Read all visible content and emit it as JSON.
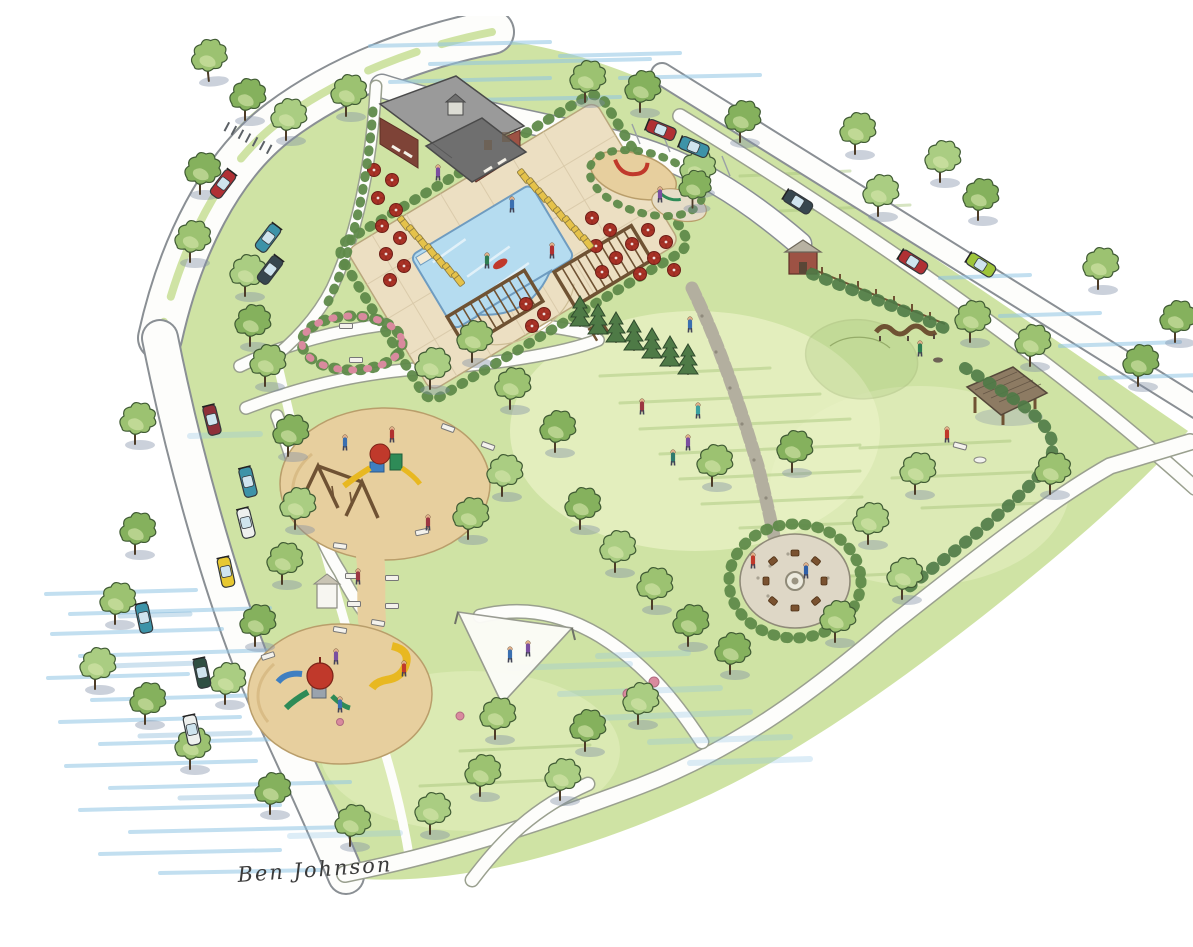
{
  "signature": {
    "text": "Ben Johnson"
  },
  "colors": {
    "page": "#ffffff",
    "grass": "#cfe3a4",
    "grassDark": "#a4c477",
    "lawnLight": "#e9f2c6",
    "water": "#8fc4e4",
    "waterDark": "#5e9ec9",
    "road": "#fdfdfb",
    "roadEdge": "#8a8f94",
    "stone": "#b3af9f",
    "stonePatio": "#ded7c6",
    "sand": "#e7cf9e",
    "sandEdge": "#b99e6b",
    "pool": "#b5dcf0",
    "poolEdge": "#6f9cc0",
    "poolDeck": "#ecdfc2",
    "brick": "#9d5244",
    "brickDark": "#7e4337",
    "roof": "#9a9a9a",
    "roofDark": "#6f6f6f",
    "roofBrown": "#8d7b63",
    "umbrella": "#a93226",
    "lounger": "#e5c24a",
    "pergola": "#6f5233",
    "hedge": "#5f8a4a",
    "evergreen": "#4e7a46",
    "treeA": "#9cc271",
    "treeB": "#85b15d",
    "treeC": "#aacd82",
    "treeHi": "#d8e8ad",
    "treeShadow": "#7e8ba5",
    "trunk": "#4d3c28",
    "flower": "#d98a9e",
    "chair": "#7a5230",
    "equipRed": "#c0392b",
    "slideYellow": "#e8b821",
    "slideGreen": "#2e8b57",
    "slideBlue": "#3f7fc1",
    "carRed": "#b03034",
    "carMaroon": "#8e3039",
    "carTeal": "#3d93a8",
    "carWhite": "#eef0ee",
    "carYellow": "#e7c832",
    "carGreen": "#2f4f42",
    "carDark": "#37474f",
    "carLime": "#9ec43a",
    "ink": "#3a3a3a"
  },
  "features": [
    {
      "id": "clubhouse",
      "label": "Clubhouse"
    },
    {
      "id": "swimming-pool",
      "label": "Swimming pool"
    },
    {
      "id": "pool-terrace",
      "label": "Pool terrace with umbrellas and loungers"
    },
    {
      "id": "pergolas",
      "label": "Pergolas"
    },
    {
      "id": "tot-lot",
      "label": "Tot lot playground"
    },
    {
      "id": "playground-north",
      "label": "North sand playground with swing set"
    },
    {
      "id": "playground-south",
      "label": "South sand playground with slides"
    },
    {
      "id": "shade-sail",
      "label": "Shade sail"
    },
    {
      "id": "fire-pit-patio",
      "label": "Fire pit patio"
    },
    {
      "id": "rose-garden",
      "label": "Rose garden ring with benches"
    },
    {
      "id": "serpentine-bench",
      "label": "Serpentine bench"
    },
    {
      "id": "picnic-pavilion",
      "label": "Picnic pavilion"
    },
    {
      "id": "garden-shed",
      "label": "Garden shed"
    },
    {
      "id": "event-lawn",
      "label": "Open event lawn"
    },
    {
      "id": "berm",
      "label": "Grass berm"
    },
    {
      "id": "boulevard",
      "label": "Entry boulevard with median and crosswalk"
    },
    {
      "id": "street-parking",
      "label": "On-street parking"
    },
    {
      "id": "walking-paths",
      "label": "Walking path loop"
    },
    {
      "id": "flagstone-walk",
      "label": "Flagstone walk"
    }
  ]
}
